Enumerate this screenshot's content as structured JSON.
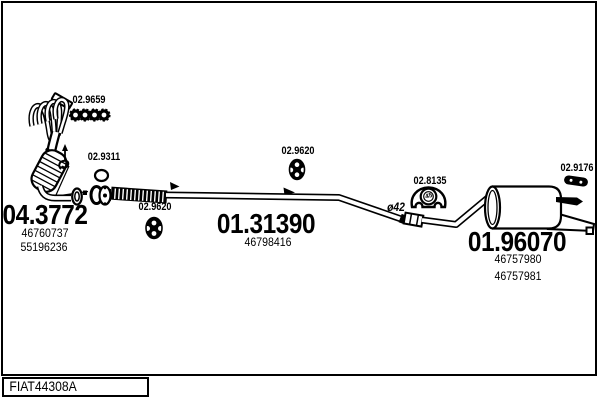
{
  "page": {
    "background": "#ffffff",
    "line_color": "#000000"
  },
  "title_block": {
    "code": "FIAT44308A"
  },
  "diagram": {
    "sections": [
      {
        "id": "front-catalyst",
        "code": "04.3772",
        "part_numbers": [
          "46760737",
          "55196236"
        ]
      },
      {
        "id": "centre-pipe",
        "code": "01.31390",
        "part_numbers": [
          "46798416"
        ]
      },
      {
        "id": "rear-silencer",
        "code": "01.96070",
        "part_numbers": [
          "46757980",
          "46757981"
        ]
      }
    ],
    "fittings": [
      {
        "id": "manifold-gasket-set",
        "code": "02.9659"
      },
      {
        "id": "seal-ring",
        "code": "02.9311"
      },
      {
        "id": "rubber-mount-front",
        "code": "02.9620"
      },
      {
        "id": "rubber-mount-mid",
        "code": "02.9620"
      },
      {
        "id": "rubber-mount-rear",
        "code": "02.8135",
        "marking": "45"
      },
      {
        "id": "rubber-mount-tail",
        "code": "02.9176"
      }
    ],
    "annotations": [
      {
        "id": "pipe-diameter",
        "text": "ø42"
      }
    ]
  }
}
